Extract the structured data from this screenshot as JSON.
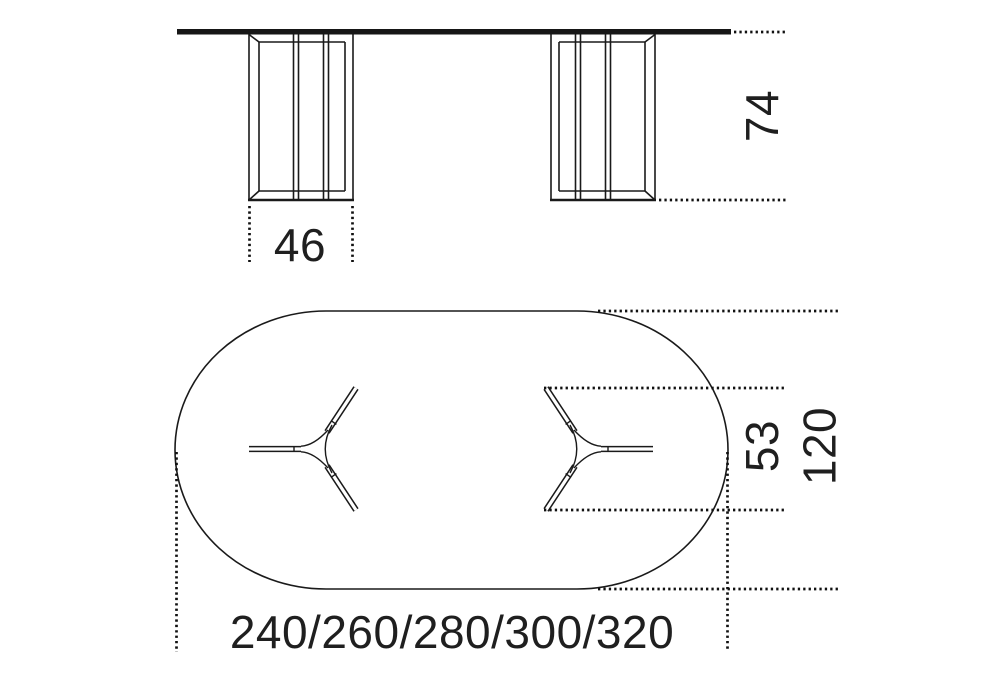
{
  "drawing": {
    "type": "furniture-technical-dimension-drawing",
    "views": {
      "front_elevation": "table with two pedestal legs",
      "top_plan": "oval table top with two three-spoke pedestals"
    },
    "dimensions": {
      "table_height": "74",
      "pedestal_width": "46",
      "pedestal_depth": "53",
      "top_depth": "120",
      "top_lengths": "240/260/280/300/320"
    },
    "colors": {
      "line": "#1a1a1a",
      "text": "#1f1f1f",
      "background": "#ffffff"
    }
  }
}
